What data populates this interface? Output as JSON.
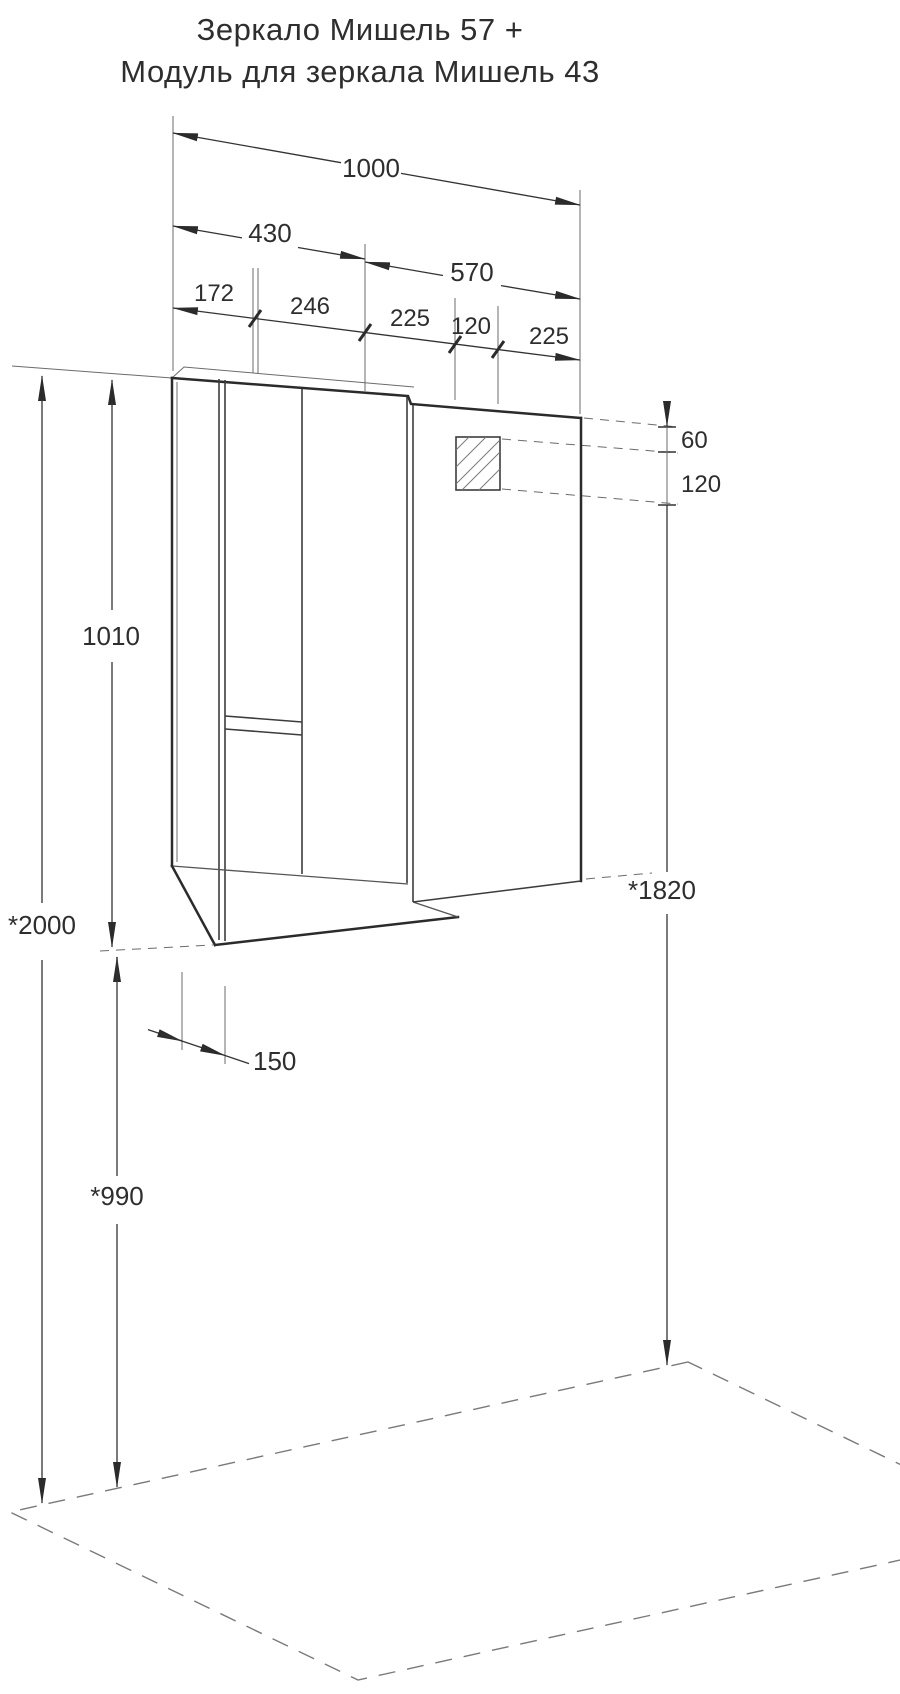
{
  "title": {
    "line1": "Зеркало Мишель 57 +",
    "line2": "Модуль для зеркала Мишель 43"
  },
  "dims": {
    "total_width": "1000",
    "module_width": "430",
    "mirror_width": "570",
    "segments": [
      "172",
      "246",
      "225",
      "120",
      "225"
    ],
    "top_offset": "60",
    "fixture_height": "120",
    "cabinet_height": "1010",
    "overall_height": "*2000",
    "mirror_top_height": "*1820",
    "depth": "150",
    "floor_clearance": "*990"
  },
  "colors": {
    "background": "#ffffff",
    "line_heavy": "#2b2b2b",
    "line_thin": "#6b6b6b",
    "text": "#2e2e2e"
  }
}
